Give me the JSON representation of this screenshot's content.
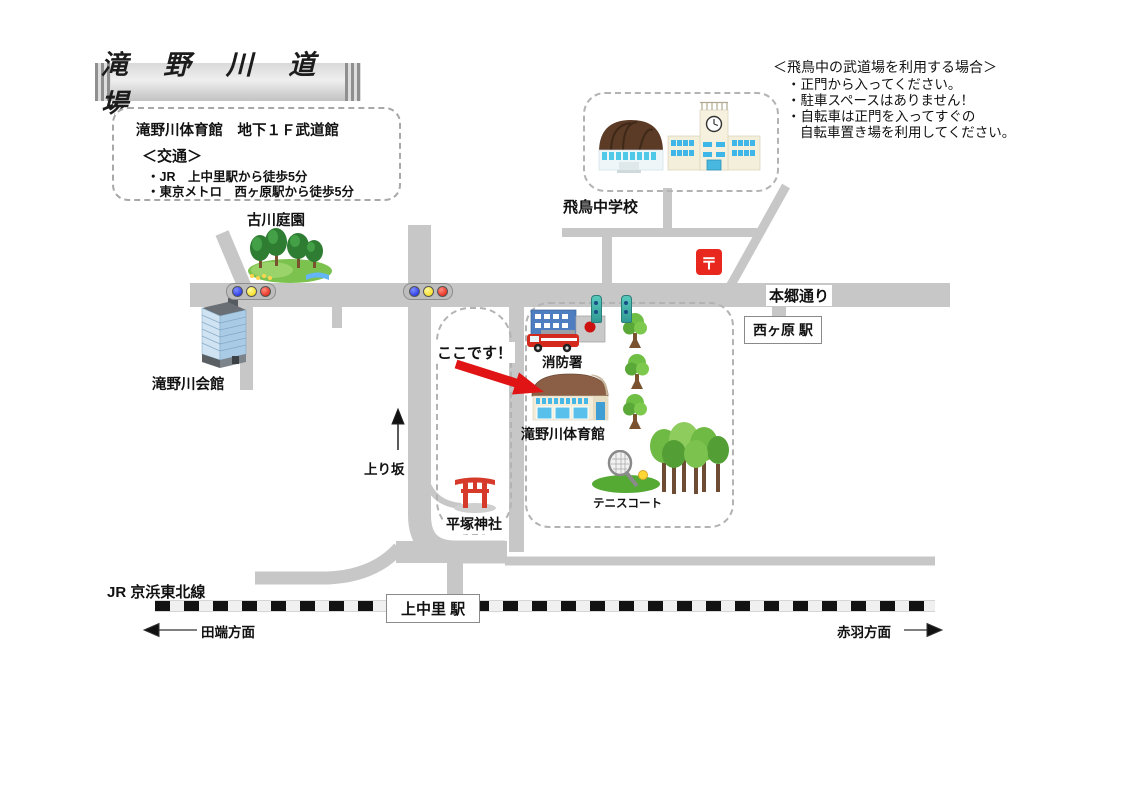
{
  "title": "滝 野 川 道 場",
  "info_box": {
    "line1": "滝野川体育館　地下１Ｆ武道館",
    "heading": "＜交通＞",
    "item1": "・JR　上中里駅から徒歩5分",
    "item2": "・東京メトロ　西ヶ原駅から徒歩5分"
  },
  "notice": {
    "heading": "＜飛鳥中の武道場を利用する場合＞",
    "item1": "・正門から入ってください。",
    "item2": "・駐車スペースはありません！",
    "item3": "・自転車は正門を入ってすぐの",
    "item4": "自転車置き場を利用してください。"
  },
  "map_labels": {
    "asuka_school": "飛鳥中学校",
    "furukawa_garden": "古川庭園",
    "hongo_street": "本郷通り",
    "nishigahara_station": "西ヶ原 駅",
    "takinogawa_kaikan": "滝野川会館",
    "koko_desu": "ここです！",
    "fire_station": "消防署",
    "takinogawa_gym": "滝野川体育館",
    "tennis_court": "テニスコート",
    "hiratsuka_shrine": "平塚神社",
    "uphill": "上り坂",
    "jr_line": "JR 京浜東北線",
    "kaminakazato_station": "上中里 駅",
    "tabata_direction": "田端方面",
    "akabane_direction": "赤羽方面"
  },
  "icons": {
    "post_office_mark": "〒"
  },
  "colors": {
    "road": "#c7c7c7",
    "arrow_red": "#e01414",
    "post_office_red": "#e8281e",
    "torii_red": "#d63a2a",
    "tree_green": "#5aa838",
    "railway_black": "#121212"
  }
}
